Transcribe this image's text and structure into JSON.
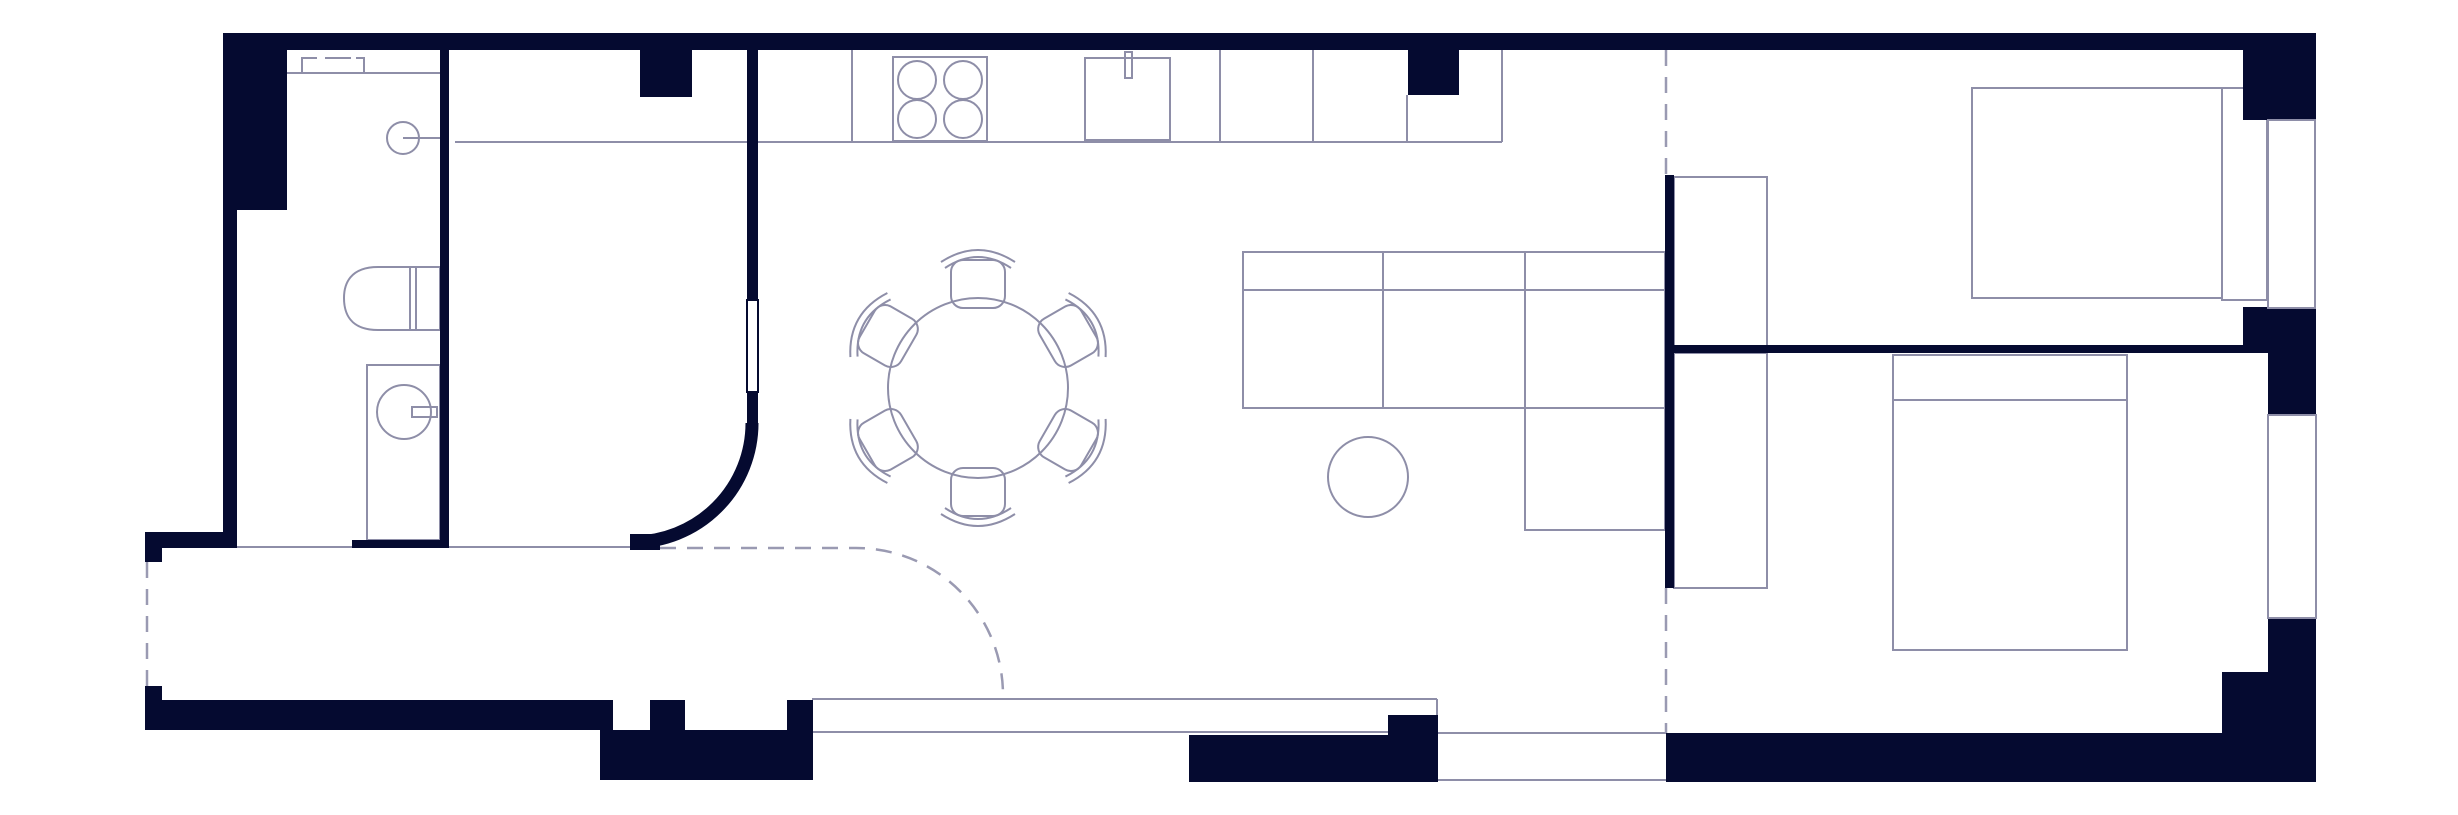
{
  "document": {
    "type": "apartment-floor-plan",
    "orientation": "landscape"
  },
  "colors": {
    "wall": "#050A30",
    "line": "#8E8EA8",
    "dash": "#9A9AB2",
    "glass": "#8E8EA8",
    "floor": "#FFFFFF"
  },
  "symbols": {
    "dining_table": "round-dining-table",
    "dining_chair": "dining-chair",
    "sofa": "sectional-sofa-with-chaise",
    "coffee_table": "round-coffee-table",
    "bed_primary": "double-bed",
    "bed_secondary": "double-bed-with-pillow",
    "wardrobe_1": "wardrobe",
    "wardrobe_2": "wardrobe",
    "cooktop": "four-burner-cooktop",
    "sink": "kitchen-sink-with-faucet",
    "toilet": "toilet",
    "vanity": "vanity-basin-with-faucet",
    "closet": "entry-closet",
    "door_arc": "curved-partition-wall",
    "opening_swing": "dashed-floor-transition-arc",
    "windows": "recessed-windows",
    "terrace": "terrace-with-parapet"
  },
  "counts": {
    "dining_chairs": 6,
    "bedrooms": 2,
    "windows_right_wall": 2
  }
}
